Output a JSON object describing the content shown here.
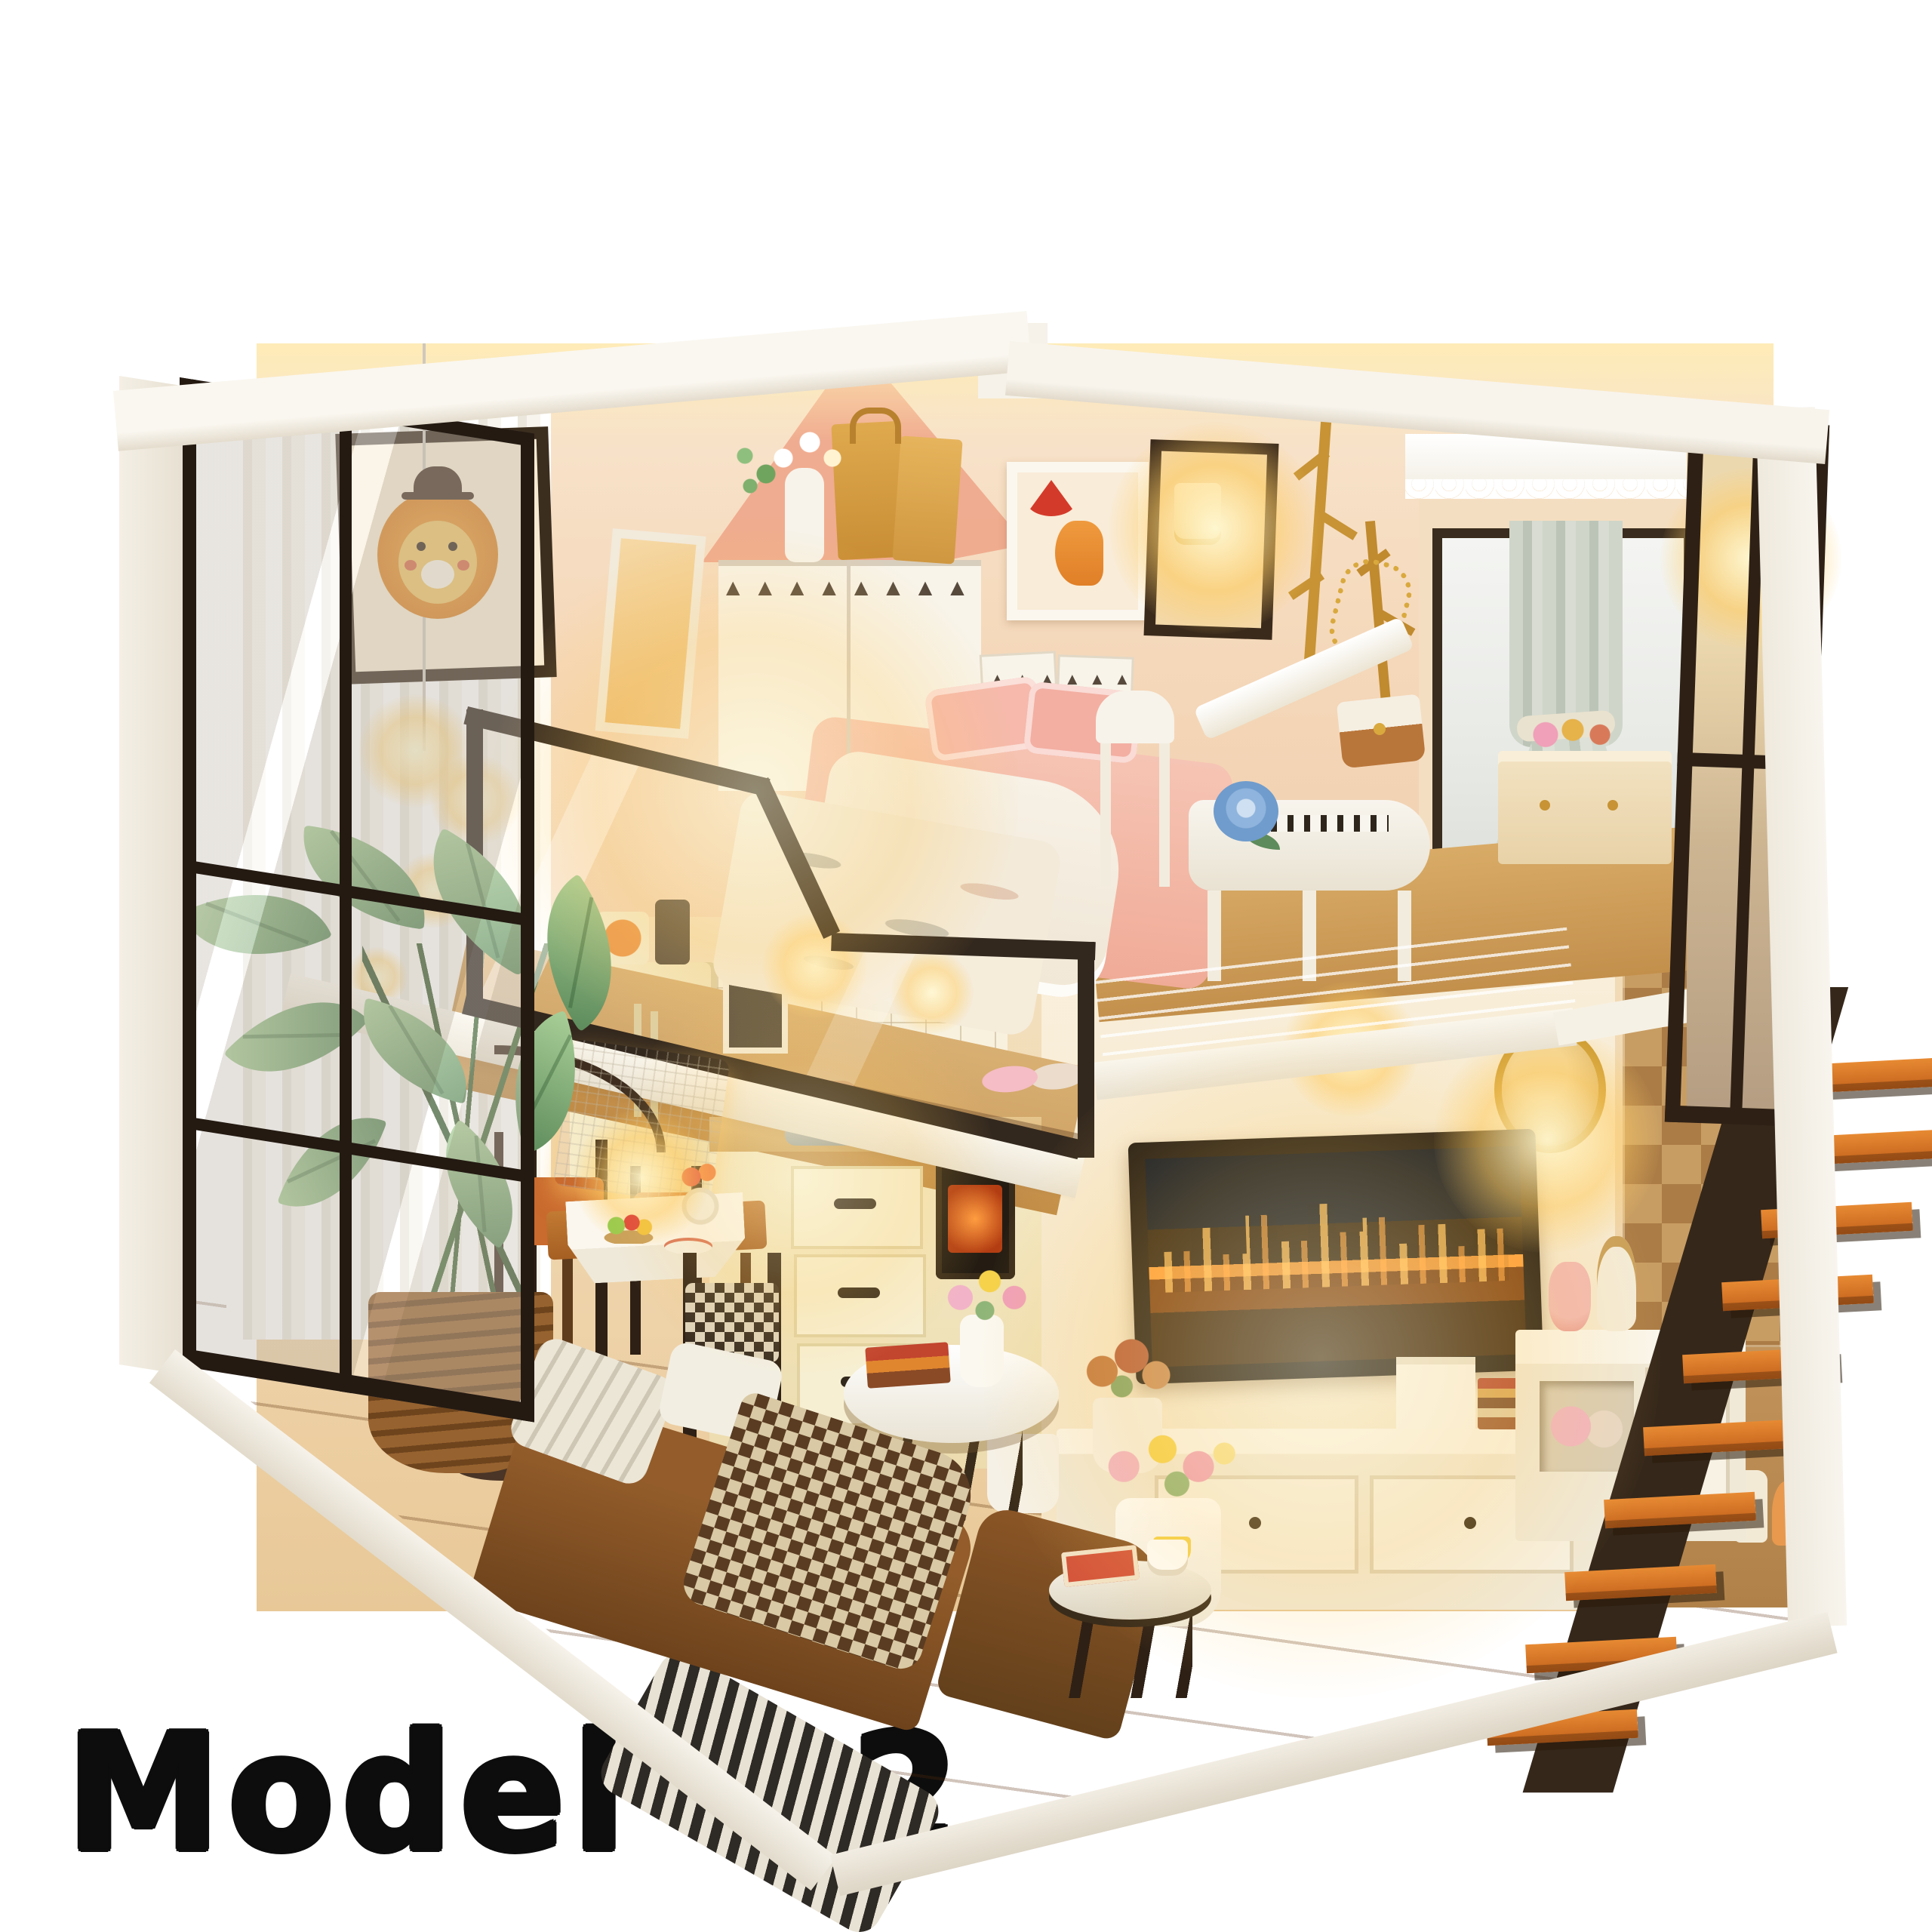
{
  "caption": {
    "text": "Model 02"
  },
  "photo": {
    "type": "product-photo",
    "subject": "DIY miniature dollhouse kit, two-level loft apartment diorama lit with warm LED lights, viewed from the open front corner on a white background",
    "rooms": [
      "loft-bedroom",
      "living-room",
      "kitchen",
      "dining-area",
      "staircase"
    ]
  },
  "objects": {
    "bedroom": [
      "lion-wall-art",
      "pendant-lights",
      "leaning-mirror",
      "wardrobe-triangle-doors",
      "paper-bags",
      "flower-vase",
      "double-bed",
      "pink-pillows",
      "lace-blanket",
      "fox-umbrella-wall-art",
      "sconce-lamp-frame",
      "branch-coat-racks",
      "gold-chain-bag",
      "window-lace-valance",
      "gray-curtain",
      "vanity-desk",
      "white-chair",
      "grand-piano",
      "blue-rose",
      "handbag",
      "pink-slippers"
    ],
    "living_room": [
      "feather-mural",
      "wall-tv-city-skyline",
      "tv-stand",
      "book-stacks",
      "amber-clock",
      "snake-plant",
      "rose-pot",
      "tulip-jug",
      "brown-leather-sofa",
      "plaid-blanket",
      "throw-pillows",
      "striped-rug",
      "oval-coffee-table",
      "red-books",
      "tulip-vase",
      "round-side-table",
      "teacup",
      "red-magazine"
    ],
    "kitchen_dining": [
      "refrigerator",
      "pumpkin-tin",
      "tile-backsplash",
      "sink",
      "kitchen-drawers",
      "oven",
      "shelf-plants",
      "dining-table",
      "table-runner",
      "food-plates",
      "fruit-bowl",
      "dining-chairs",
      "arc-floor-lamp",
      "potted-plant-wicker-basket"
    ],
    "staircase": [
      "orange-stair-treads",
      "dark-stringer",
      "checkered-tile-wall",
      "under-stair-cabinet",
      "toiletry-bottles",
      "round-gold-mirror",
      "loft-glass-railing",
      "acrylic-guard",
      "window-pane-partition"
    ]
  },
  "palette": {
    "page_bg": "#ffffff",
    "caption_text": "#0d0d0d",
    "structure_white": "#f3eee4",
    "wall_peach": "#f5dcc0",
    "wall_pink_accent": "#efa78b",
    "warm_glow": "#ffd27a",
    "frame_dark": "#32261b",
    "stair_orange": "#d26f23",
    "checker_tan": "#c89d63",
    "checker_brown": "#ab7c46",
    "sofa_brown": "#7e4e22",
    "bed_pink": "#f5b9ab",
    "curtain_gray": "#cdd3c8",
    "floor_wood": "#b06f3e"
  }
}
